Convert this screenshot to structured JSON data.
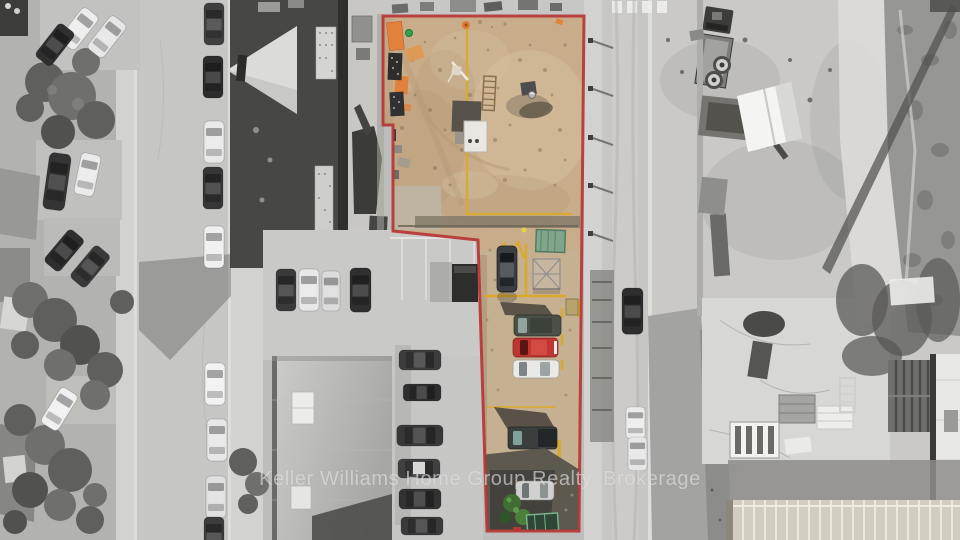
{
  "image": {
    "kind": "aerial-drone-photo",
    "treatment": "grayscale surroundings with listed property shown in color inside a red boundary outline"
  },
  "watermark": {
    "text": "Keller Williams Home Group Realty, Brokerage"
  },
  "colors": {
    "outline_red": "#b73535",
    "lot_dirt": "#c9ad8b",
    "strip_pavement": "#c6b092",
    "pipe_yellow": "#d9a92e",
    "pallet_orange": "#e2813c",
    "shed_green": "#7fa68c",
    "bush_green": "#3f6d33",
    "car_red": "#bf3531",
    "dumpster_green": "#79b089"
  },
  "property": {
    "parcels": [
      {
        "name": "main-lot",
        "appearance": "vacant graded dirt lot with construction materials"
      },
      {
        "name": "access-strip",
        "appearance": "narrow parking strip with vehicles"
      }
    ],
    "strip_vehicle_colors": [
      "black",
      "dark-green",
      "red",
      "white",
      "dark-gray",
      "white"
    ]
  }
}
